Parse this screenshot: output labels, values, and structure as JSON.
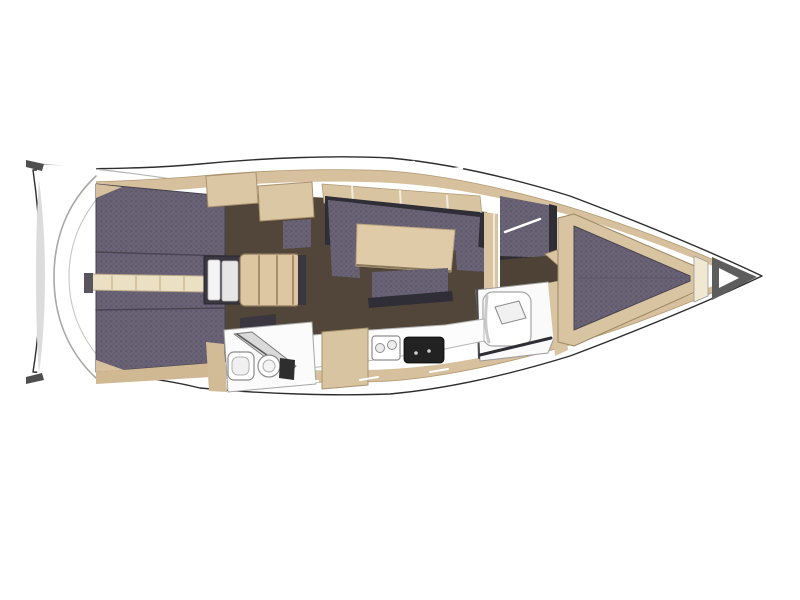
{
  "canvas": {
    "width": 800,
    "height": 600,
    "background": "#ffffff"
  },
  "palette": {
    "hull_white": "#ffffff",
    "deck_beige": "#d7c09d",
    "wood_beige": "#dcc7a4",
    "cushion_purple": "#6b6476",
    "cushion_dot": "#5f596b",
    "floor_brown": "#52463a",
    "floor_brown_dark": "#4e4236",
    "charcoal": "#2f2d35",
    "cream": "#f0e8d0",
    "gray_shade": "#a8a8a8"
  },
  "shapes": [
    {
      "name": "hull-outline",
      "type": "path",
      "d": "M762,276 C705,249 636,221 570,196 C505,176 445,163 390,158 C335,155 263,158 200,164 C135,170 80,168 33,170 C43,240 43,310 33,372 C80,374 135,372 200,388 C263,394 335,396 390,394 C445,389 505,376 570,356 C636,331 705,303 762,276 Z",
      "fill": "#ffffff",
      "stroke": "#2e2e2e",
      "sw": 1.4
    },
    {
      "name": "toe-rail-line-top",
      "type": "path",
      "d": "M36,164 C95,168 160,176 212,186",
      "fill": "none",
      "stroke": "#b5b5b5",
      "sw": 1.2
    },
    {
      "name": "toe-rail-line-bottom",
      "type": "path",
      "d": "M36,378 C95,374 160,370 212,366",
      "fill": "none",
      "stroke": "#b5b5b5",
      "sw": 1.2
    },
    {
      "name": "side-deck-band",
      "type": "path",
      "d": "M750,276 C696,251 632,226 566,206 C504,188 444,175 390,171 C335,168 264,170 200,176 C140,181 92,182 46,183 C40,183 38,186 39,194 C45,244 45,308 39,358 C38,366 40,369 46,369 C92,370 140,371 200,376 C264,382 335,384 390,381 C444,377 504,364 566,346 C632,326 696,301 750,276 Z",
      "fill": "#d7c09d",
      "stroke": "#b39972",
      "sw": 0.8
    },
    {
      "name": "interior-deck-white",
      "type": "path",
      "d": "M737,276 C684,254 624,230 562,213 C500,197 446,186 392,183 C335,180 264,182 200,188 C146,193 100,193 56,194 C50,194 48,197 49,204 C54,248 54,304 49,348 C48,355 50,358 56,358 C100,358 146,357 200,364 C264,370 335,372 392,369 C446,366 500,355 562,339 C624,322 684,298 737,276 Z",
      "fill": "#ffffff"
    },
    {
      "name": "midship-cabin-floor",
      "type": "polygon",
      "points": "215,192 330,198 487,212 487,330 455,334 370,336 300,342 215,332",
      "fill": "#52463a"
    },
    {
      "name": "transom-platform",
      "type": "path",
      "d": "M46,165 C64,165 80,166 96,168 L96,384 C80,386 64,387 46,387 C38,387 36,384 37,375 C43,315 43,235 37,178 C36,168 38,165 46,165 Z",
      "fill": "#ffffff"
    },
    {
      "name": "transom-shade-crescent",
      "type": "path",
      "d": "M39,180 C47,240 47,314 39,374 C35,326 35,226 39,180 Z",
      "fill": "#dcdcdc"
    },
    {
      "name": "transom-curve-outer",
      "type": "path",
      "d": "M96,176 C66,204 54,240 54,277 C54,314 66,350 96,378",
      "fill": "none",
      "stroke": "#a8a8a8",
      "sw": 1.6
    },
    {
      "name": "transom-curve-inner",
      "type": "path",
      "d": "M96,200 C76,226 69,251 69,277 C69,303 76,328 96,354",
      "fill": "none",
      "stroke": "#c6c6c6",
      "sw": 1.1
    },
    {
      "name": "stern-cleat-top",
      "type": "polygon",
      "points": "26,160 44,164 42,171 26,167",
      "fill": "#4f4f4f"
    },
    {
      "name": "stern-cleat-bottom",
      "type": "polygon",
      "points": "26,384 44,380 42,373 26,377",
      "fill": "#4f4f4f"
    },
    {
      "name": "cockpit-bench-cushions",
      "type": "polygon",
      "points": "96,184 225,196 225,362 96,372",
      "fill": "pattern:cushion",
      "stroke": "#46414c",
      "sw": 1
    },
    {
      "name": "cockpit-bench-seam-top",
      "type": "line",
      "x1": 96,
      "y1": 252,
      "x2": 225,
      "y2": 256,
      "stroke": "#4a4452",
      "sw": 1.5
    },
    {
      "name": "cockpit-bench-seam-bottom",
      "type": "line",
      "x1": 96,
      "y1": 310,
      "x2": 225,
      "y2": 308,
      "stroke": "#4a4452",
      "sw": 1.5
    },
    {
      "name": "cockpit-trim-wedge-top",
      "type": "polygon",
      "points": "96,184 122,187 96,198",
      "fill": "#d7c09d"
    },
    {
      "name": "cockpit-trim-wedge-bottom",
      "type": "polygon",
      "points": "96,372 124,370 96,360",
      "fill": "#d7c09d"
    },
    {
      "name": "aft-side-deck-wedge",
      "type": "polygon",
      "points": "96,372 225,362 228,376 96,384",
      "fill": "#cfb892"
    },
    {
      "name": "cockpit-walkway",
      "type": "polygon",
      "points": "86,274 205,276 205,292 86,290",
      "fill": "#ece0c4",
      "stroke": "#b9a887",
      "sw": 1
    },
    {
      "name": "walkway-end-bracket",
      "type": "rect",
      "x": 84,
      "y": 273,
      "w": 9,
      "h": 20,
      "fill": "#58555e"
    },
    {
      "name": "walkway-plank-line-1",
      "type": "line",
      "x1": 112,
      "y1": 276,
      "x2": 112,
      "y2": 290,
      "stroke": "#cdbb97",
      "sw": 1.5
    },
    {
      "name": "walkway-plank-line-2",
      "type": "line",
      "x1": 136,
      "y1": 276,
      "x2": 136,
      "y2": 290,
      "stroke": "#cdbb97",
      "sw": 1.5
    },
    {
      "name": "walkway-plank-line-3",
      "type": "line",
      "x1": 160,
      "y1": 276,
      "x2": 160,
      "y2": 290,
      "stroke": "#cdbb97",
      "sw": 1.5
    },
    {
      "name": "walkway-plank-line-4",
      "type": "line",
      "x1": 184,
      "y1": 276,
      "x2": 184,
      "y2": 290,
      "stroke": "#cdbb97",
      "sw": 1.5
    },
    {
      "name": "aft-charcoal-locker",
      "type": "polygon",
      "points": "240,318 276,314 276,333 240,337",
      "fill": "#3a3741"
    },
    {
      "name": "companionway-frame",
      "type": "rect",
      "x": 204,
      "y": 256,
      "w": 38,
      "h": 48,
      "fill": "#3a3741",
      "stroke": "#27252d",
      "sw": 1
    },
    {
      "name": "companionway-door-panel-left",
      "type": "rect",
      "x": 208,
      "y": 260,
      "w": 12,
      "h": 40,
      "rx": 2,
      "fill": "#f4f4f4",
      "stroke": "#b9b9b9",
      "sw": 0.8
    },
    {
      "name": "companionway-door-panel-right",
      "type": "rect",
      "x": 222,
      "y": 261,
      "w": 16,
      "h": 40,
      "rx": 2,
      "fill": "#e6e6e6",
      "stroke": "#b9b9b9",
      "sw": 0.8
    },
    {
      "name": "companionway-steps",
      "type": "rect",
      "x": 240,
      "y": 254,
      "w": 60,
      "h": 52,
      "rx": 5,
      "fill": "#dcc7a2",
      "stroke": "#8d7a58",
      "sw": 1.2
    },
    {
      "name": "companionway-step-edge-1",
      "type": "line",
      "x1": 259,
      "y1": 256,
      "x2": 259,
      "y2": 304,
      "stroke": "#a78f67",
      "sw": 2
    },
    {
      "name": "companionway-step-edge-2",
      "type": "line",
      "x1": 277,
      "y1": 256,
      "x2": 277,
      "y2": 304,
      "stroke": "#a78f67",
      "sw": 2
    },
    {
      "name": "companionway-step-edge-3",
      "type": "line",
      "x1": 293,
      "y1": 256,
      "x2": 293,
      "y2": 304,
      "stroke": "#a78f67",
      "sw": 2
    },
    {
      "name": "companionway-threshold-bar",
      "type": "rect",
      "x": 298,
      "y": 255,
      "w": 8,
      "h": 50,
      "fill": "#3a3741"
    },
    {
      "name": "aft-cabin-cushion-patch",
      "type": "polygon",
      "points": "283,221 311,219 311,247 283,249",
      "fill": "pattern:cushion"
    },
    {
      "name": "coachroof-locker-aft",
      "type": "polygon",
      "points": "206,176 256,172 258,203 208,207",
      "fill": "#dcc7a4",
      "stroke": "#a9926d",
      "sw": 1
    },
    {
      "name": "coachroof-locker-fwd",
      "type": "polygon",
      "points": "258,186 312,182 314,217 260,221",
      "fill": "#dcc7a4",
      "stroke": "#a9926d",
      "sw": 1
    },
    {
      "name": "salon-shelf-band",
      "type": "polygon",
      "points": "322,184 480,196 482,215 324,203",
      "fill": "#d9c4a2",
      "stroke": "#b09a76",
      "sw": 0.8
    },
    {
      "name": "salon-shelf-seam-1",
      "type": "line",
      "x1": 352,
      "y1": 186,
      "x2": 353,
      "y2": 204,
      "stroke": "#f2ecdc",
      "sw": 2
    },
    {
      "name": "salon-shelf-seam-2",
      "type": "line",
      "x1": 400,
      "y1": 191,
      "x2": 401,
      "y2": 209,
      "stroke": "#f2ecdc",
      "sw": 2
    },
    {
      "name": "salon-shelf-seam-3",
      "type": "line",
      "x1": 447,
      "y1": 196,
      "x2": 448,
      "y2": 213,
      "stroke": "#f2ecdc",
      "sw": 2
    },
    {
      "name": "salon-backrest-top",
      "type": "polygon",
      "points": "325,196 480,212 480,219 325,203",
      "fill": "#2f2d35"
    },
    {
      "name": "salon-backrest-left",
      "type": "polygon",
      "points": "325,196 332,197 332,245 325,245",
      "fill": "#2f2d35"
    },
    {
      "name": "salon-backrest-right",
      "type": "polygon",
      "points": "476,212 484,213 487,272 479,272",
      "fill": "#2f2d35"
    },
    {
      "name": "salon-sofa-top-bench",
      "type": "polygon",
      "points": "328,200 480,217 478,252 330,241",
      "fill": "pattern:cushion"
    },
    {
      "name": "salon-sofa-left-arm",
      "type": "polygon",
      "points": "328,200 356,203 360,278 332,276",
      "fill": "pattern:cushion"
    },
    {
      "name": "salon-sofa-right-arm",
      "type": "polygon",
      "points": "455,242 484,248 486,272 457,270",
      "fill": "pattern:cushion"
    },
    {
      "name": "salon-table",
      "type": "polygon",
      "points": "357,224 455,230 451,272 356,266",
      "fill": "#e0cba8",
      "stroke": "#b8a37f",
      "sw": 1
    },
    {
      "name": "salon-table-shadow",
      "type": "line",
      "x1": 357,
      "y1": 265,
      "x2": 450,
      "y2": 271,
      "stroke": "#8a7a5c",
      "sw": 2
    },
    {
      "name": "salon-sofa-bottom-bench",
      "type": "polygon",
      "points": "372,272 448,268 448,298 372,304",
      "fill": "pattern:cushion"
    },
    {
      "name": "salon-sofa-bottom-bar",
      "type": "polygon",
      "points": "368,298 452,291 453,301 369,308",
      "fill": "#2f2d35"
    },
    {
      "name": "fwd-bulkhead-band",
      "type": "polygon",
      "points": "484,212 498,214 498,332 484,331",
      "fill": "#d9c4a2"
    },
    {
      "name": "fwd-bulkhead-gap",
      "type": "line",
      "x1": 494,
      "y1": 214,
      "x2": 494,
      "y2": 330,
      "stroke": "#f7f3ea",
      "sw": 1.5
    },
    {
      "name": "fwd-cabin-berth-cushion",
      "type": "polygon",
      "points": "500,196 553,206 553,260 500,258",
      "fill": "pattern:cushion"
    },
    {
      "name": "fwd-berth-blanket-line",
      "type": "line",
      "x1": 505,
      "y1": 232,
      "x2": 540,
      "y2": 219,
      "stroke": "#ffffff",
      "sw": 2.5
    },
    {
      "name": "fwd-berth-edge-right",
      "type": "polygon",
      "points": "549,204 557,206 557,262 549,261",
      "fill": "#2f2d35"
    },
    {
      "name": "fwd-berth-edge-bottom",
      "type": "polygon",
      "points": "500,256 553,258 553,264 500,262",
      "fill": "#2f2d35"
    },
    {
      "name": "fwd-cabin-floor",
      "type": "polygon",
      "points": "500,260 590,252 648,276 648,290 565,309 500,314",
      "fill": "#4e4236"
    },
    {
      "name": "fwd-cabin-vanity-band",
      "type": "polygon",
      "points": "545,254 557,250 614,298 603,305",
      "fill": "#d9c4a2",
      "stroke": "#a8926d",
      "sw": 0.8
    },
    {
      "name": "fwd-head-room",
      "type": "polygon",
      "points": "476,290 548,282 561,293 562,318 548,353 480,361",
      "fill": "#fafafa",
      "stroke": "#9a9a9a",
      "sw": 1
    },
    {
      "name": "fwd-head-wall-line",
      "type": "line",
      "x1": 477,
      "y1": 288,
      "x2": 479,
      "y2": 358,
      "stroke": "#4a4a4a",
      "sw": 2
    },
    {
      "name": "fwd-head-toilet-unit",
      "type": "rect",
      "x": 483,
      "y": 292,
      "w": 48,
      "h": 54,
      "rx": 10,
      "fill": "#ffffff",
      "stroke": "#a5a5a5",
      "sw": 1.2
    },
    {
      "name": "fwd-head-toilet-shade",
      "type": "path",
      "d": "M487,296 C485,316 485,330 489,342",
      "fill": "none",
      "stroke": "#c9c9c9",
      "sw": 3
    },
    {
      "name": "fwd-head-toilet-lid",
      "type": "polygon",
      "points": "495,307 519,301 526,318 502,324",
      "fill": "#f1f1f1",
      "stroke": "#8a8a8a",
      "sw": 1
    },
    {
      "name": "fwd-head-door-line",
      "type": "line",
      "x1": 480,
      "y1": 355,
      "x2": 551,
      "y2": 338,
      "stroke": "#2f2d35",
      "sw": 3
    },
    {
      "name": "fwd-head-trim",
      "type": "polygon",
      "points": "548,283 562,280 568,350 555,356",
      "fill": "#d9c4a2"
    },
    {
      "name": "vberth-platform",
      "type": "polygon",
      "points": "558,218 574,214 704,270 704,288 574,346 558,342",
      "fill": "#d9c4a2",
      "stroke": "#9c8862",
      "sw": 1
    },
    {
      "name": "vberth-mattress",
      "type": "polygon",
      "points": "574,226 690,276 690,281 574,330",
      "fill": "pattern:cushion",
      "stroke": "#4a4550",
      "sw": 1
    },
    {
      "name": "vberth-center-seam",
      "type": "line",
      "x1": 578,
      "y1": 278,
      "x2": 686,
      "y2": 278,
      "stroke": "#5c5668",
      "sw": 1
    },
    {
      "name": "bow-locker-band",
      "type": "polygon",
      "points": "694,256 708,262 708,296 694,302",
      "fill": "#f0e8d0",
      "stroke": "#9a9a9a",
      "sw": 0.8
    },
    {
      "name": "bow-anchor-locker",
      "type": "polygon",
      "points": "712,257 757,277 712,300",
      "fill": "#5d5d5d"
    },
    {
      "name": "bow-anchor-locker-inner",
      "type": "polygon",
      "points": "719,268 739,278 719,288",
      "fill": "#ffffff"
    },
    {
      "name": "galley-counter",
      "type": "polygon",
      "points": "302,336 370,330 445,325 484,319 484,341 430,352 360,362 302,369",
      "fill": "#fcfcfc",
      "stroke": "#b5b5b5",
      "sw": 1
    },
    {
      "name": "galley-cabinet",
      "type": "polygon",
      "points": "322,332 368,328 368,385 322,389",
      "fill": "#d9c4a2",
      "stroke": "#a8926d",
      "sw": 1
    },
    {
      "name": "galley-sink",
      "type": "rect",
      "x": 372,
      "y": 336,
      "w": 28,
      "h": 24,
      "rx": 3,
      "fill": "#ffffff",
      "stroke": "#8f8f8f",
      "sw": 1.2
    },
    {
      "name": "galley-sink-bowl-left",
      "type": "circle",
      "cx": 380,
      "cy": 348,
      "r": 4.5,
      "fill": "#ececec",
      "stroke": "#8f8f8f",
      "sw": 1
    },
    {
      "name": "galley-sink-bowl-right",
      "type": "circle",
      "cx": 392,
      "cy": 345,
      "r": 4.5,
      "fill": "#ececec",
      "stroke": "#8f8f8f",
      "sw": 1
    },
    {
      "name": "galley-stove",
      "type": "rect",
      "x": 404,
      "y": 337,
      "w": 40,
      "h": 26,
      "rx": 4,
      "fill": "#222222",
      "stroke": "#000000",
      "sw": 0.8
    },
    {
      "name": "galley-stove-knob-1",
      "type": "circle",
      "cx": 416,
      "cy": 353,
      "r": 1.8,
      "fill": "#cfcfcf"
    },
    {
      "name": "galley-stove-knob-2",
      "type": "circle",
      "cx": 429,
      "cy": 351,
      "r": 1.8,
      "fill": "#cfcfcf"
    },
    {
      "name": "aft-head-wall",
      "type": "polygon",
      "points": "206,342 224,344 227,392 209,391",
      "fill": "#d2bc97"
    },
    {
      "name": "aft-head-room",
      "type": "polygon",
      "points": "224,330 312,322 316,384 228,392",
      "fill": "#fbfbfb",
      "stroke": "#a5a5a5",
      "sw": 1
    },
    {
      "name": "aft-head-shower-panel",
      "type": "polygon",
      "points": "234,334 252,332 296,366 288,374",
      "fill": "#dadada",
      "stroke": "#7c7c7c",
      "sw": 1
    },
    {
      "name": "aft-head-shower-line",
      "type": "line",
      "x1": 237,
      "y1": 334,
      "x2": 291,
      "y2": 372,
      "stroke": "#565656",
      "sw": 1.5
    },
    {
      "name": "aft-head-sink",
      "type": "rect",
      "x": 228,
      "y": 352,
      "w": 26,
      "h": 28,
      "rx": 6,
      "fill": "#ffffff",
      "stroke": "#8a8a8a",
      "sw": 1.2
    },
    {
      "name": "aft-head-sink-bowl",
      "type": "rect",
      "x": 232,
      "y": 357,
      "w": 17,
      "h": 18,
      "rx": 6,
      "fill": "#f0f0f0",
      "stroke": "#b0b0b0",
      "sw": 1
    },
    {
      "name": "aft-head-toilet",
      "type": "circle",
      "cx": 269,
      "cy": 366,
      "r": 11,
      "fill": "#ffffff",
      "stroke": "#8a8a8a",
      "sw": 1.2
    },
    {
      "name": "aft-head-toilet-bowl",
      "type": "circle",
      "cx": 269,
      "cy": 366,
      "r": 6,
      "fill": "#f4f4f4",
      "stroke": "#aaaaaa",
      "sw": 1
    },
    {
      "name": "aft-head-toilet-tank",
      "type": "polygon",
      "points": "280,358 295,360 294,380 279,378",
      "fill": "#2e2e2e"
    },
    {
      "name": "deck-hatch-seam-top-1",
      "type": "line",
      "x1": 340,
      "y1": 166,
      "x2": 358,
      "y2": 163,
      "stroke": "#ffffff",
      "sw": 2.5
    },
    {
      "name": "deck-hatch-seam-top-2",
      "type": "line",
      "x1": 396,
      "y1": 164,
      "x2": 414,
      "y2": 162,
      "stroke": "#ffffff",
      "sw": 2.5
    },
    {
      "name": "deck-hatch-seam-top-3",
      "type": "line",
      "x1": 446,
      "y1": 170,
      "x2": 462,
      "y2": 168,
      "stroke": "#ffffff",
      "sw": 2.5
    },
    {
      "name": "deck-hatch-seam-bottom-1",
      "type": "line",
      "x1": 300,
      "y1": 383,
      "x2": 318,
      "y2": 381,
      "stroke": "#ffffff",
      "sw": 2
    },
    {
      "name": "deck-hatch-seam-bottom-2",
      "type": "line",
      "x1": 360,
      "y1": 380,
      "x2": 378,
      "y2": 377,
      "stroke": "#ffffff",
      "sw": 2
    },
    {
      "name": "deck-hatch-seam-bottom-3",
      "type": "line",
      "x1": 430,
      "y1": 372,
      "x2": 448,
      "y2": 369,
      "stroke": "#ffffff",
      "sw": 2
    }
  ]
}
